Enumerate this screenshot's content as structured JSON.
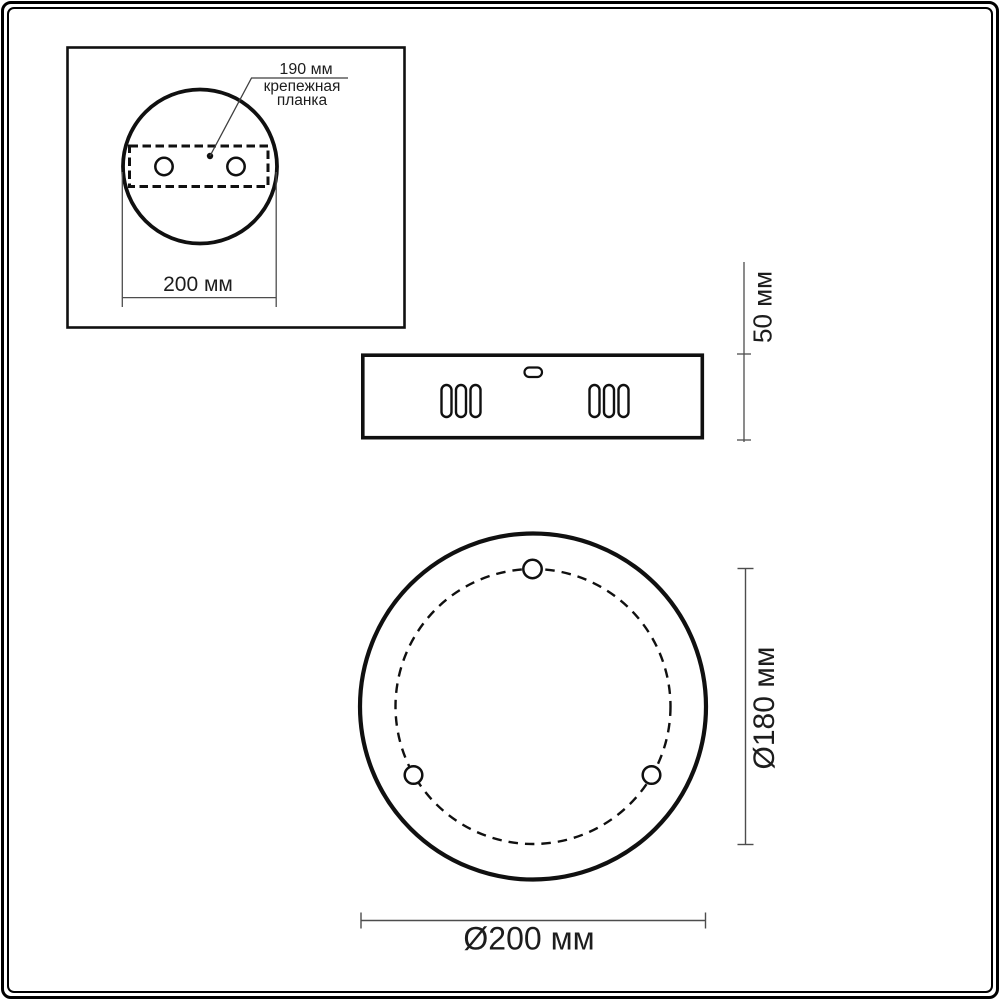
{
  "inset": {
    "leader_dim": "190 мм",
    "leader_caption": [
      "крепежная",
      "планка"
    ],
    "width_dim": "200 мм"
  },
  "side_view": {
    "height_dim": "50 мм"
  },
  "front_view": {
    "bolt_circle_dim": "Ø180 мм",
    "outer_diameter_dim": "Ø200 мм"
  },
  "colors": {
    "ink": "#101010",
    "dim_line": "#4d4d4d",
    "text": "#1d1d1d",
    "background": "#ffffff"
  }
}
